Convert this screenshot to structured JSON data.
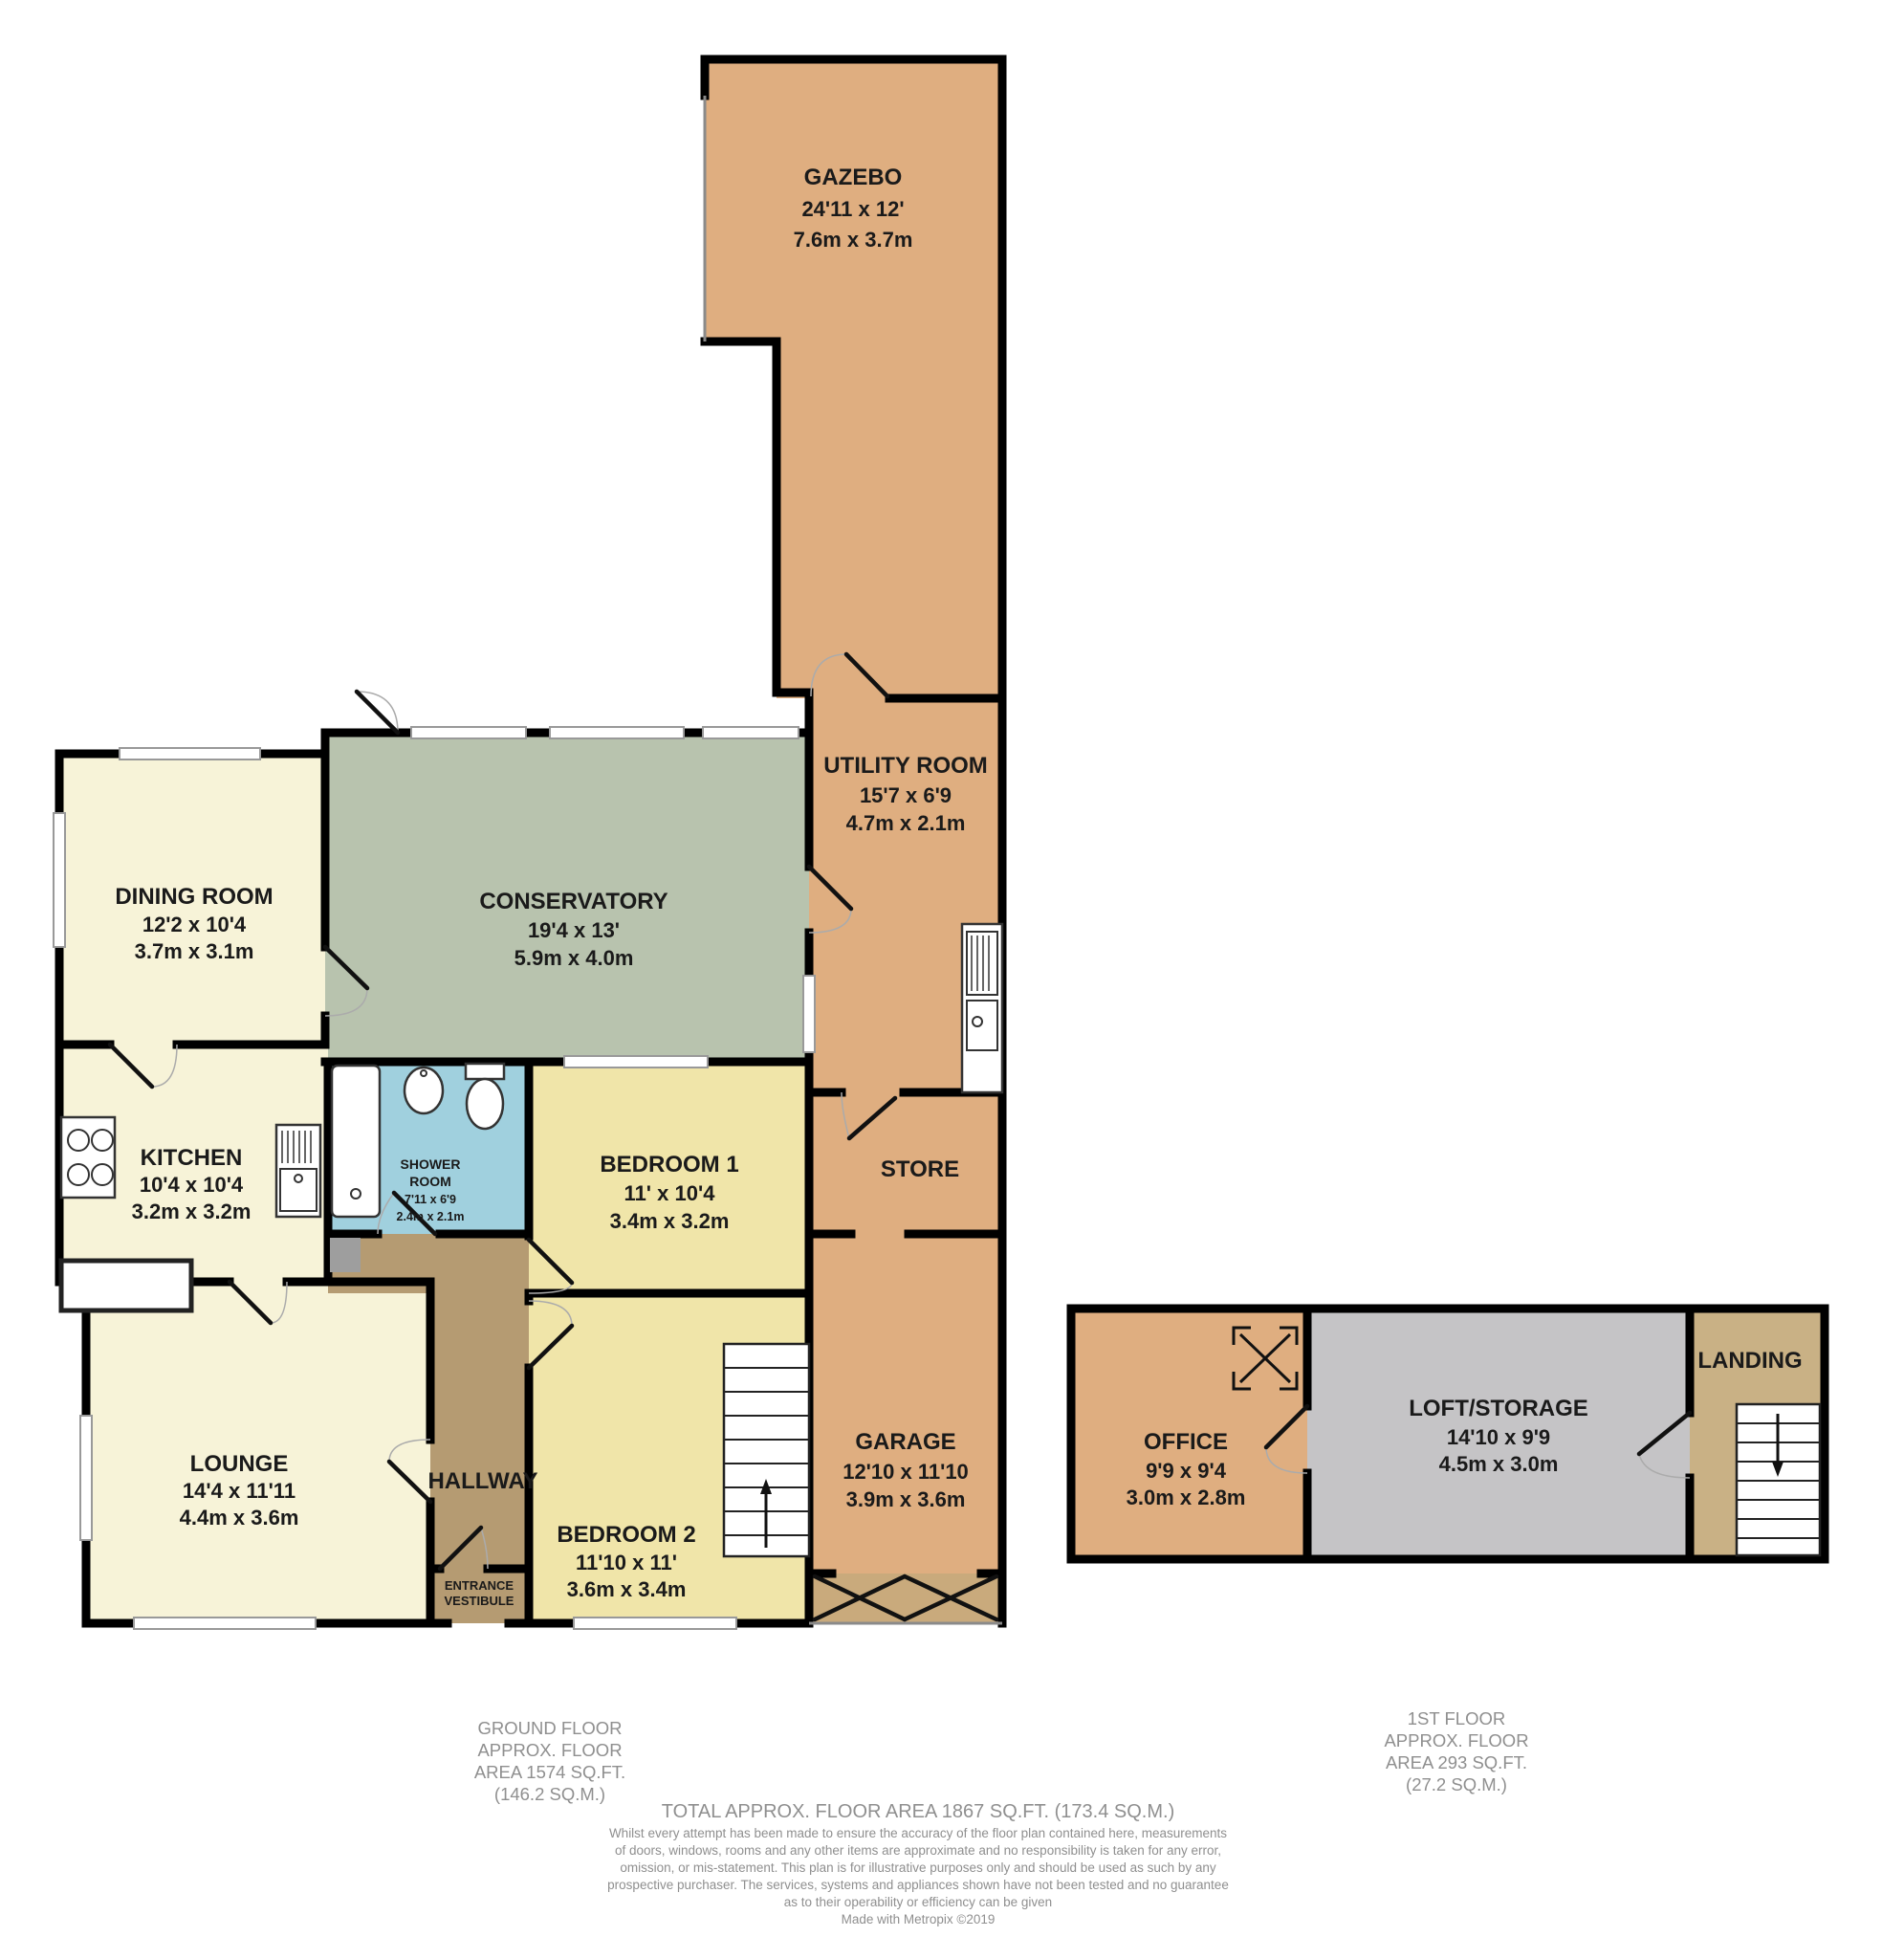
{
  "colors": {
    "tan": "#DFAE80",
    "cream": "#F7F3D8",
    "yellow": "#F0E5A9",
    "sage": "#B8C3AE",
    "blue": "#A0D0DE",
    "brown": "#B59B72",
    "landing": "#C9B185",
    "loft_gray": "#C5C4C6",
    "garage_door": "#C9AA7C",
    "wall": "#000000",
    "label": "#1a1a1a",
    "footer_text": "#8f8f8f"
  },
  "rooms": {
    "gazebo": {
      "name": "GAZEBO",
      "imperial": "24'11 x 12'",
      "metric": "7.6m x 3.7m"
    },
    "utility": {
      "name": "UTILITY ROOM",
      "imperial": "15'7 x 6'9",
      "metric": "4.7m x 2.1m"
    },
    "store": {
      "name": "STORE"
    },
    "garage": {
      "name": "GARAGE",
      "imperial": "12'10 x 11'10",
      "metric": "3.9m x 3.6m"
    },
    "dining": {
      "name": "DINING ROOM",
      "imperial": "12'2 x 10'4",
      "metric": "3.7m x 3.1m"
    },
    "conservatory": {
      "name": "CONSERVATORY",
      "imperial": "19'4 x 13'",
      "metric": "5.9m x 4.0m"
    },
    "kitchen": {
      "name": "KITCHEN",
      "imperial": "10'4 x 10'4",
      "metric": "3.2m x 3.2m"
    },
    "shower": {
      "name_line1": "SHOWER",
      "name_line2": "ROOM",
      "imperial": "7'11 x 6'9",
      "metric": "2.4m x 2.1m"
    },
    "bedroom1": {
      "name": "BEDROOM 1",
      "imperial": "11' x 10'4",
      "metric": "3.4m x 3.2m"
    },
    "bedroom2": {
      "name": "BEDROOM 2",
      "imperial": "11'10 x 11'",
      "metric": "3.6m x 3.4m"
    },
    "lounge": {
      "name": "LOUNGE",
      "imperial": "14'4 x 11'11",
      "metric": "4.4m x 3.6m"
    },
    "hallway": {
      "name": "HALLWAY"
    },
    "vestibule": {
      "line1": "ENTRANCE",
      "line2": "VESTIBULE"
    },
    "office": {
      "name": "OFFICE",
      "imperial": "9'9 x 9'4",
      "metric": "3.0m x 2.8m"
    },
    "loft": {
      "name": "LOFT/STORAGE",
      "imperial": "14'10 x 9'9",
      "metric": "4.5m x 3.0m"
    },
    "landing": {
      "name": "LANDING"
    }
  },
  "footer": {
    "ground_floor_lines": [
      "GROUND FLOOR",
      "APPROX. FLOOR",
      "AREA 1574 SQ.FT.",
      "(146.2 SQ.M.)"
    ],
    "first_floor_lines": [
      "1ST FLOOR",
      "APPROX. FLOOR",
      "AREA 293 SQ.FT.",
      "(27.2 SQ.M.)"
    ],
    "total": "TOTAL APPROX. FLOOR AREA 1867 SQ.FT. (173.4 SQ.M.)",
    "disclaimer_lines": [
      "Whilst every attempt has been made to ensure the accuracy of the floor plan contained here, measurements",
      "of doors, windows, rooms and any other items are approximate and no responsibility is taken for any error,",
      "omission, or mis-statement. This plan is for illustrative purposes only and should be used as such by any",
      "prospective purchaser. The services, systems and appliances shown have not been tested and no guarantee",
      "as to their operability or efficiency can be given",
      "Made with Metropix ©2019"
    ]
  }
}
